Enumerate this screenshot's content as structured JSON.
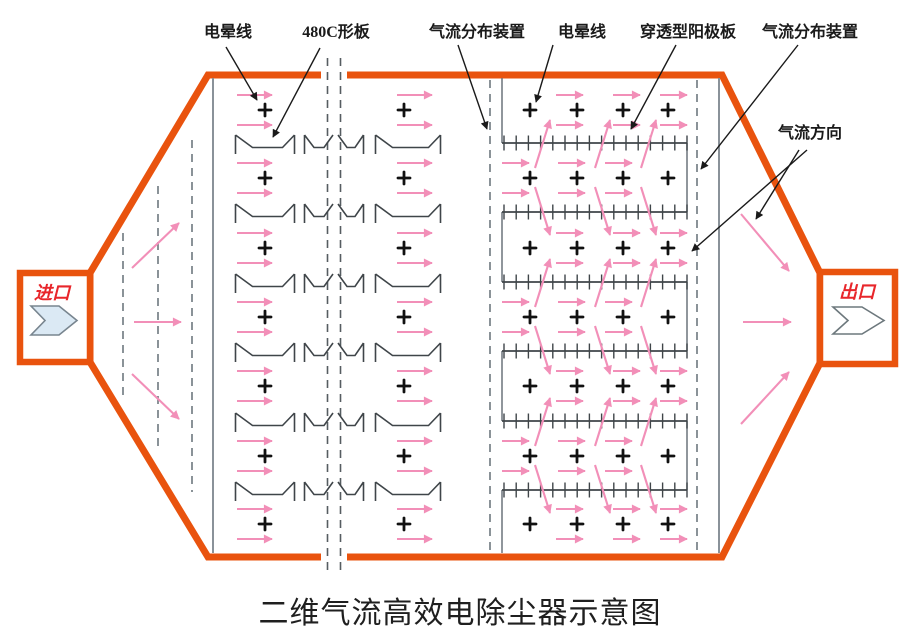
{
  "diagram": {
    "title": "二维气流高效电除尘器示意图",
    "annotations": {
      "corona_wire_left": "电晕线",
      "c_plate": "480C形板",
      "flow_distributor_left": "气流分布装置",
      "corona_wire_right": "电晕线",
      "anode_plate": "穿透型阳极板",
      "flow_distributor_right": "气流分布装置",
      "flow_direction": "气流方向"
    },
    "inlet_label": "进口",
    "outlet_label": "出口",
    "corona_symbol": "+",
    "colors": {
      "shell_orange": "#E9530E",
      "flow_pink": "#F28FB8",
      "annotation_black": "#1A1A1A",
      "port_red": "#E8262B",
      "inlet_chevron_fill": "#DBE9F4",
      "structure_gray": "#6E787E",
      "plate_dark": "#3F4549"
    }
  }
}
